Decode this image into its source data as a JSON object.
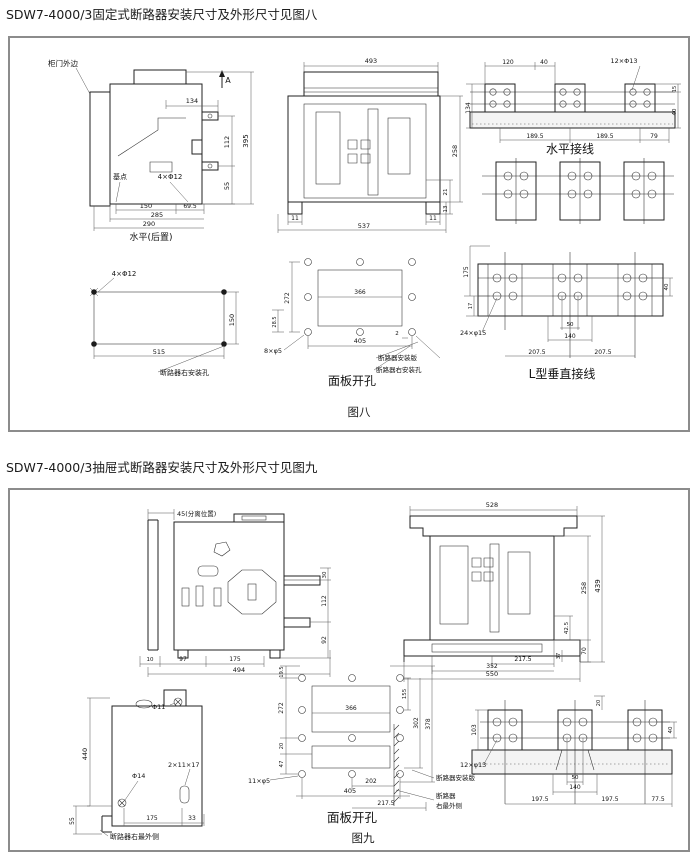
{
  "colors": {
    "paper": "#ffffff",
    "ink": "#1b1b1b",
    "frame_border": "#8c8c8c",
    "dim_line": "#555555"
  },
  "titles": {
    "fig8": "SDW7-4000/3固定式断路器安装尺寸及外形尺寸见图八",
    "fig9": "SDW7-4000/3抽屉式断路器安装尺寸及外形尺寸见图九"
  },
  "fig8": {
    "figure_label": "图八",
    "side_view": {
      "caption": "水平(后置)",
      "labels": [
        {
          "x": 2,
          "y": 10,
          "t": "柜门外边",
          "s": 7.5,
          "a": "s",
          "n": "label-cabinet-door-edge"
        },
        {
          "x": 182,
          "y": 27,
          "t": "A",
          "s": 8,
          "n": "section-arrow-label"
        },
        {
          "x": 146,
          "y": 47,
          "t": "134",
          "s": 6.5
        },
        {
          "x": 183,
          "y": 86,
          "t": "112",
          "r": -90,
          "s": 6.5
        },
        {
          "x": 183,
          "y": 130,
          "t": "55",
          "r": -90,
          "s": 6.5
        },
        {
          "x": 202,
          "y": 85,
          "t": "395",
          "r": -90,
          "s": 7
        },
        {
          "x": 74,
          "y": 123,
          "t": "基点",
          "s": 7,
          "n": "label-base-point"
        },
        {
          "x": 124,
          "y": 123,
          "t": "4×Φ12",
          "s": 7,
          "n": "label-hole-spec"
        },
        {
          "x": 100,
          "y": 152,
          "t": "150",
          "s": 6.5
        },
        {
          "x": 144,
          "y": 152,
          "t": "69.5",
          "s": 6
        },
        {
          "x": 111,
          "y": 161,
          "t": "285",
          "s": 6.5
        },
        {
          "x": 103,
          "y": 170,
          "t": "290",
          "s": 6.5
        },
        {
          "x": 105,
          "y": 184,
          "t": "水平(后置)",
          "s": 9,
          "n": "view-caption"
        }
      ]
    },
    "front_view": {
      "labels": [
        {
          "x": 95,
          "y": 9,
          "t": "493",
          "s": 6.5
        },
        {
          "x": 181,
          "y": 97,
          "t": "258",
          "r": -90,
          "s": 6.5
        },
        {
          "x": 171,
          "y": 138,
          "t": "21",
          "r": -90,
          "s": 5.5
        },
        {
          "x": 171,
          "y": 155,
          "t": "13",
          "r": -90,
          "s": 5.5
        },
        {
          "x": 19,
          "y": 166,
          "t": "11",
          "s": 6
        },
        {
          "x": 157,
          "y": 166,
          "t": "11",
          "s": 6
        },
        {
          "x": 88,
          "y": 174,
          "t": "537",
          "s": 6.5
        }
      ]
    },
    "horizontal_connection": {
      "caption": "水平接线",
      "labels": [
        {
          "x": 46,
          "y": 10,
          "t": "120",
          "s": 6
        },
        {
          "x": 82,
          "y": 10,
          "t": "40",
          "s": 6
        },
        {
          "x": 162,
          "y": 9,
          "t": "12×Φ13",
          "s": 6.5,
          "n": "label-hole-spec"
        },
        {
          "x": 8,
          "y": 54,
          "t": "134",
          "r": -90,
          "s": 6
        },
        {
          "x": 214,
          "y": 35,
          "t": "15",
          "r": -90,
          "s": 5
        },
        {
          "x": 214,
          "y": 58,
          "t": "40",
          "r": -90,
          "s": 5.5
        },
        {
          "x": 73,
          "y": 84,
          "t": "189.5",
          "s": 6
        },
        {
          "x": 143,
          "y": 84,
          "t": "189.5",
          "s": 6
        },
        {
          "x": 192,
          "y": 84,
          "t": "79",
          "s": 6
        },
        {
          "x": 108,
          "y": 99,
          "t": "水平接线",
          "s": 12,
          "n": "view-caption"
        }
      ]
    },
    "l_vertical_connection": {
      "caption": "L型垂直接线",
      "labels": [
        {
          "x": 8,
          "y": 38,
          "t": "175",
          "r": -90,
          "s": 6
        },
        {
          "x": 12,
          "y": 72,
          "t": "17",
          "r": -90,
          "s": 5
        },
        {
          "x": 0,
          "y": 101,
          "t": "24×φ15",
          "s": 6.5,
          "a": "s",
          "n": "label-hole-spec"
        },
        {
          "x": 208,
          "y": 53,
          "t": "40",
          "r": -90,
          "s": 5.5
        },
        {
          "x": 110,
          "y": 92,
          "t": "50",
          "s": 5.5
        },
        {
          "x": 110,
          "y": 104,
          "t": "140",
          "s": 6
        },
        {
          "x": 77,
          "y": 120,
          "t": "207.5",
          "s": 6
        },
        {
          "x": 143,
          "y": 120,
          "t": "207.5",
          "s": 6
        },
        {
          "x": 102,
          "y": 144,
          "t": "L型垂直接线",
          "s": 12,
          "n": "view-caption"
        }
      ]
    },
    "mounting_holes": {
      "labels": [
        {
          "x": 62,
          "y": 12,
          "t": "4×Φ12",
          "s": 7,
          "n": "label-hole-spec"
        },
        {
          "x": 172,
          "y": 56,
          "t": "150",
          "r": -90,
          "s": 6.5
        },
        {
          "x": 97,
          "y": 90,
          "t": "515",
          "s": 6.5
        },
        {
          "x": 98,
          "y": 111,
          "t": "断路器右安装孔",
          "s": 7,
          "a": "s",
          "n": "label-breaker-right-mount-hole"
        }
      ]
    },
    "panel_cutout": {
      "caption": "面板开孔",
      "labels": [
        {
          "x": 39,
          "y": 56,
          "t": "272",
          "r": -90,
          "s": 6
        },
        {
          "x": 26,
          "y": 80,
          "t": "28.5",
          "r": -90,
          "s": 5
        },
        {
          "x": 110,
          "y": 52,
          "t": "366",
          "s": 6
        },
        {
          "x": 14,
          "y": 111,
          "t": "8×φ5",
          "s": 6.5,
          "a": "s",
          "n": "label-hole-spec"
        },
        {
          "x": 110,
          "y": 101,
          "t": "405",
          "s": 6.5
        },
        {
          "x": 147,
          "y": 93,
          "t": "2",
          "s": 5.5
        },
        {
          "x": 128,
          "y": 118,
          "t": "断路器安装版",
          "s": 6.5,
          "a": "s",
          "n": "label-breaker-mount-plate"
        },
        {
          "x": 126,
          "y": 130,
          "t": "断路器右安装孔",
          "s": 6.5,
          "a": "s",
          "n": "label-breaker-right-mount-hole"
        },
        {
          "x": 102,
          "y": 143,
          "t": "面板开孔",
          "s": 12,
          "n": "view-caption"
        }
      ]
    }
  },
  "fig9": {
    "figure_label": "图九",
    "side_view": {
      "labels": [
        {
          "x": 43,
          "y": 16,
          "t": "45(分离位置)",
          "s": 6.5,
          "a": "s",
          "n": "label-separated-position"
        },
        {
          "x": 192,
          "y": 75,
          "t": "30",
          "r": -90,
          "s": 5.5
        },
        {
          "x": 192,
          "y": 101,
          "t": "112",
          "r": -90,
          "s": 6
        },
        {
          "x": 192,
          "y": 140,
          "t": "92",
          "r": -90,
          "s": 6
        },
        {
          "x": 16,
          "y": 161,
          "t": "10",
          "s": 5.5
        },
        {
          "x": 49,
          "y": 161,
          "t": "97",
          "s": 6
        },
        {
          "x": 101,
          "y": 161,
          "t": "175",
          "s": 6
        },
        {
          "x": 105,
          "y": 172,
          "t": "494",
          "s": 6.5
        }
      ]
    },
    "front_view": {
      "labels": [
        {
          "x": 100,
          "y": 9,
          "t": "528",
          "s": 6.5
        },
        {
          "x": 194,
          "y": 90,
          "t": "258",
          "r": -90,
          "s": 6.5
        },
        {
          "x": 208,
          "y": 88,
          "t": "439",
          "r": -90,
          "s": 7
        },
        {
          "x": 176,
          "y": 130,
          "t": "42.5",
          "r": -90,
          "s": 5.5
        },
        {
          "x": 194,
          "y": 153,
          "t": "70",
          "r": -90,
          "s": 6
        },
        {
          "x": 168,
          "y": 158,
          "t": "37",
          "r": -90,
          "s": 5
        },
        {
          "x": 131,
          "y": 163,
          "t": "217.5",
          "s": 6
        },
        {
          "x": 100,
          "y": 170,
          "t": "352",
          "s": 6
        },
        {
          "x": 100,
          "y": 178,
          "t": "550",
          "s": 6.5
        }
      ]
    },
    "side_plate": {
      "labels": [
        {
          "x": 100,
          "y": 33,
          "t": "Φ11",
          "s": 6.5,
          "a": "s",
          "n": "label-hole-spec"
        },
        {
          "x": 35,
          "y": 78,
          "t": "440",
          "r": -90,
          "s": 6.5
        },
        {
          "x": 22,
          "y": 145,
          "t": "55",
          "r": -90,
          "s": 6
        },
        {
          "x": 80,
          "y": 102,
          "t": "Φ14",
          "s": 6.5,
          "a": "s",
          "n": "label-hole-spec"
        },
        {
          "x": 116,
          "y": 91,
          "t": "2×11×17",
          "s": 6.5,
          "a": "s",
          "n": "label-slot-spec"
        },
        {
          "x": 100,
          "y": 144,
          "t": "175",
          "s": 6
        },
        {
          "x": 140,
          "y": 144,
          "t": "33",
          "s": 6
        },
        {
          "x": 58,
          "y": 163,
          "t": "断路器右最外侧",
          "s": 7,
          "a": "s",
          "n": "label-breaker-rightmost-side"
        }
      ]
    },
    "panel_cutout": {
      "caption": "面板开孔",
      "labels": [
        {
          "x": 43,
          "y": 14,
          "t": "19.5",
          "r": -90,
          "s": 5
        },
        {
          "x": 43,
          "y": 50,
          "t": "272",
          "r": -90,
          "s": 6
        },
        {
          "x": 43,
          "y": 88,
          "t": "20",
          "r": -90,
          "s": 5
        },
        {
          "x": 43,
          "y": 106,
          "t": "47",
          "r": -90,
          "s": 5.5
        },
        {
          "x": 111,
          "y": 52,
          "t": "366",
          "s": 6
        },
        {
          "x": 166,
          "y": 36,
          "t": "155",
          "r": -90,
          "s": 5.5
        },
        {
          "x": 178,
          "y": 65,
          "t": "302",
          "r": -90,
          "s": 6
        },
        {
          "x": 190,
          "y": 66,
          "t": "378",
          "r": -90,
          "s": 6
        },
        {
          "x": 8,
          "y": 125,
          "t": "11×φ5",
          "s": 6.5,
          "a": "s",
          "n": "label-hole-spec"
        },
        {
          "x": 131,
          "y": 125,
          "t": "202",
          "s": 6
        },
        {
          "x": 110,
          "y": 135,
          "t": "405",
          "s": 6.5
        },
        {
          "x": 146,
          "y": 147,
          "t": "217.5",
          "s": 6
        },
        {
          "x": 196,
          "y": 122,
          "t": "断路器安装版",
          "s": 6.5,
          "a": "s",
          "n": "label-breaker-mount-plate"
        },
        {
          "x": 196,
          "y": 140,
          "t": "断路器",
          "s": 6.5,
          "a": "s",
          "n": "label-breaker-rightmost-side"
        },
        {
          "x": 196,
          "y": 150,
          "t": "右最外侧",
          "s": 6.5,
          "a": "s",
          "n": "label-breaker-rightmost-side-2"
        },
        {
          "x": 112,
          "y": 164,
          "t": "面板开孔",
          "s": 12.5,
          "n": "view-caption"
        }
      ]
    },
    "connection": {
      "labels": [
        {
          "x": 16,
          "y": 58,
          "t": "103",
          "r": -90,
          "s": 6
        },
        {
          "x": 140,
          "y": 31,
          "t": "20",
          "r": -90,
          "s": 5
        },
        {
          "x": 212,
          "y": 58,
          "t": "40",
          "r": -90,
          "s": 5.5
        },
        {
          "x": 0,
          "y": 95,
          "t": "12×φ13",
          "s": 6.5,
          "a": "s",
          "n": "label-hole-spec"
        },
        {
          "x": 115,
          "y": 107,
          "t": "50",
          "s": 5.5
        },
        {
          "x": 115,
          "y": 117,
          "t": "140",
          "s": 6
        },
        {
          "x": 80,
          "y": 129,
          "t": "197.5",
          "s": 6
        },
        {
          "x": 150,
          "y": 129,
          "t": "197.5",
          "s": 6
        },
        {
          "x": 198,
          "y": 129,
          "t": "77.5",
          "s": 6
        }
      ]
    }
  }
}
